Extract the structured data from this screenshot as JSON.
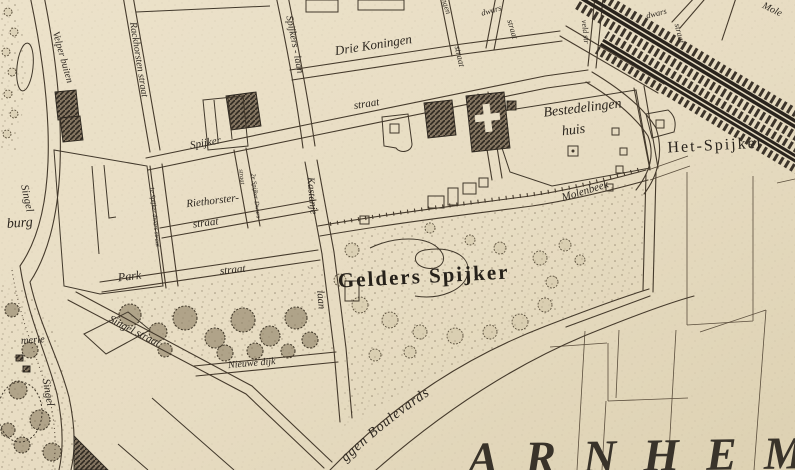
{
  "map": {
    "city_label": "ARNHEM",
    "boulevard_label": {
      "text": "ggen Boulevards"
    },
    "colors": {
      "paper": "#e9dfc7",
      "ink": "#453a2c",
      "building_fill": "#857763",
      "rail": "#2a241d",
      "text": "#2d2720"
    },
    "labels": [
      {
        "text": "Velper buiten",
        "x": 60,
        "y": 58,
        "rot": 74,
        "size": 10,
        "cls": "street"
      },
      {
        "text": "Rackhorsten straat",
        "x": 136,
        "y": 60,
        "rot": 81,
        "size": 10,
        "cls": "street"
      },
      {
        "text": "Spijkers - laan",
        "x": 292,
        "y": 45,
        "rot": 79,
        "size": 10,
        "cls": "street"
      },
      {
        "text": "Drie Koningen",
        "x": 374,
        "y": 49,
        "rot": -9,
        "size": 13,
        "cls": "street"
      },
      {
        "text": "ngen",
        "x": 444,
        "y": 7,
        "rot": 73,
        "size": 8,
        "cls": "street"
      },
      {
        "text": "straat",
        "x": 457,
        "y": 57,
        "rot": 77,
        "size": 9,
        "cls": "street"
      },
      {
        "text": "dwars",
        "x": 492,
        "y": 13,
        "rot": -16,
        "size": 8.5,
        "cls": "street"
      },
      {
        "text": "straat",
        "x": 510,
        "y": 30,
        "rot": 74,
        "size": 8.5,
        "cls": "street"
      },
      {
        "text": "dwars",
        "x": 657,
        "y": 16,
        "rot": -14,
        "size": 8.5,
        "cls": "street"
      },
      {
        "text": "straat",
        "x": 677,
        "y": 34,
        "rot": 76,
        "size": 8.5,
        "cls": "street"
      },
      {
        "text": "veld str",
        "x": 583,
        "y": 32,
        "rot": 84,
        "size": 8,
        "cls": "street"
      },
      {
        "text": "Mole",
        "x": 771,
        "y": 12,
        "rot": 26,
        "size": 10,
        "cls": "street"
      },
      {
        "text": "straat",
        "x": 367,
        "y": 107,
        "rot": -9,
        "size": 11,
        "cls": "street"
      },
      {
        "text": "Spijker",
        "x": 206,
        "y": 146,
        "rot": -10,
        "size": 11,
        "cls": "street"
      },
      {
        "text": "Bestedelingen",
        "x": 583,
        "y": 112,
        "rot": -7,
        "size": 14,
        "cls": "place"
      },
      {
        "text": "huis",
        "x": 574,
        "y": 134,
        "rot": -7,
        "size": 14,
        "cls": "place"
      },
      {
        "text": "Het-Spijker",
        "x": 716,
        "y": 150,
        "rot": -3,
        "size": 16,
        "cls": "roman"
      },
      {
        "text": "Molenbeek",
        "x": 586,
        "y": 194,
        "rot": -17,
        "size": 11,
        "cls": "street"
      },
      {
        "text": "1e Spijker dwars straat",
        "x": 153,
        "y": 217,
        "rot": 84,
        "size": 6.5,
        "cls": "street"
      },
      {
        "text": "straat",
        "x": 240,
        "y": 177,
        "rot": 83,
        "size": 6.5,
        "cls": "street"
      },
      {
        "text": "2e Spijker Dwars",
        "x": 254,
        "y": 196,
        "rot": 83,
        "size": 6.5,
        "cls": "street"
      },
      {
        "text": "Riethorster-",
        "x": 213,
        "y": 204,
        "rot": -7,
        "size": 11,
        "cls": "street"
      },
      {
        "text": "straat",
        "x": 206,
        "y": 226,
        "rot": -7,
        "size": 11,
        "cls": "street"
      },
      {
        "text": "Kastanje",
        "x": 309,
        "y": 196,
        "rot": 85,
        "size": 10.5,
        "cls": "street"
      },
      {
        "text": "laan",
        "x": 318,
        "y": 300,
        "rot": 85,
        "size": 10.5,
        "cls": "street"
      },
      {
        "text": "Singel",
        "x": 24,
        "y": 199,
        "rot": 78,
        "size": 11,
        "cls": "street"
      },
      {
        "text": "burg",
        "x": 20,
        "y": 227,
        "rot": -4,
        "size": 14,
        "cls": "place"
      },
      {
        "text": "Park",
        "x": 130,
        "y": 280,
        "rot": -7,
        "size": 12,
        "cls": "street"
      },
      {
        "text": "straat",
        "x": 233,
        "y": 273,
        "rot": -6,
        "size": 11,
        "cls": "street"
      },
      {
        "text": "Singel straat",
        "x": 133,
        "y": 334,
        "rot": 27,
        "size": 11,
        "cls": "street"
      },
      {
        "text": "Singel",
        "x": 45,
        "y": 393,
        "rot": 80,
        "size": 11,
        "cls": "street"
      },
      {
        "text": "merie",
        "x": 33,
        "y": 343,
        "rot": -4,
        "size": 10.5,
        "cls": "street"
      },
      {
        "text": "Nieuwe dijk",
        "x": 252,
        "y": 366,
        "rot": -5,
        "size": 10,
        "cls": "street"
      },
      {
        "text": "Gelders Spijker",
        "x": 424,
        "y": 283,
        "rot": -3,
        "size": 21,
        "cls": "display",
        "ls": 2
      },
      {
        "text": "ARNHEM",
        "x": 468,
        "y": 474,
        "rot": -1,
        "size": 46,
        "cls": "city",
        "ls": 27,
        "anchor": "start"
      }
    ]
  }
}
